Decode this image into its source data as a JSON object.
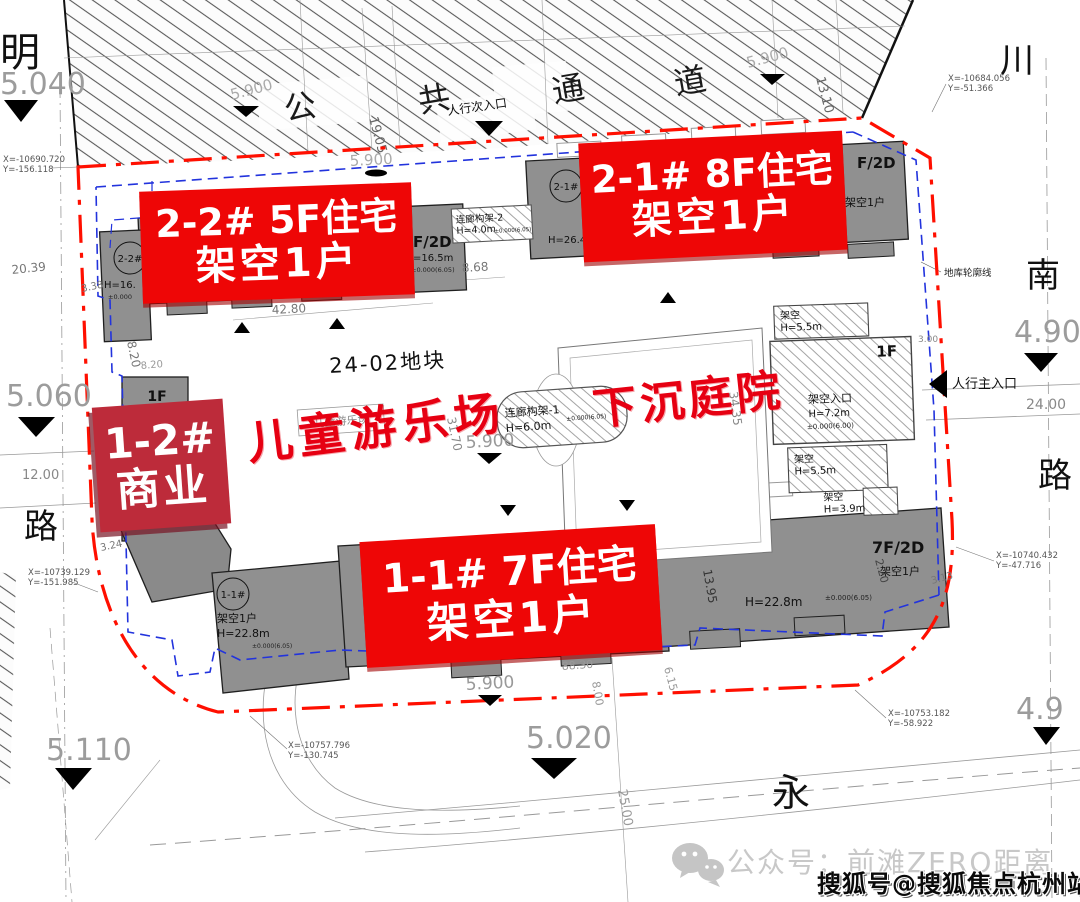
{
  "banners": {
    "b22": {
      "l1": "2-2#  5F住宅",
      "l2": "架空1户"
    },
    "b21": {
      "l1": "2-1#  8F住宅",
      "l2": "架空1户"
    },
    "b12": {
      "l1": "1-2#",
      "l2": "商业"
    },
    "b11": {
      "l1": "1-1#  7F住宅",
      "l2": "架空1户"
    }
  },
  "scripts": {
    "playground": "儿童游乐场",
    "sunken": "下沉庭院"
  },
  "roads": {
    "corridor": [
      "公",
      "共",
      "通",
      "道"
    ],
    "left_top": "明",
    "left": "路",
    "right_top": "川",
    "right_mid": "南",
    "right": "路",
    "bottom": "永"
  },
  "entrances": {
    "secondary": "人行次入口",
    "main": "人行主入口"
  },
  "plot": {
    "name": "24-02地块",
    "playground_box": "儿童游乐场",
    "garage_outline": "地库轮廓线"
  },
  "elev": {
    "e5040": "5.040",
    "e5060": "5.060",
    "e5110": "5.110",
    "e5020": "5.020",
    "e4900": "4.900",
    "e49": "4.9",
    "e59": "5.900"
  },
  "coords": {
    "c1x": "X=-10690.720",
    "c1y": "Y=-156.118",
    "c2x": "X=-10684.056",
    "c2y": "Y=-51.366",
    "c3x": "X=-10739.129",
    "c3y": "Y=-151.985",
    "c4x": "X=-10757.796",
    "c4y": "Y=-130.745",
    "c5x": "X=-10753.182",
    "c5y": "Y=-58.922",
    "c6x": "X=-10740.432",
    "c6y": "Y=-47.716"
  },
  "dims": {
    "d2039": "20.39",
    "d338": "3.38",
    "d820": "8.20",
    "d1200": "12.00",
    "d324": "3.24",
    "d4280": "42.80",
    "d868": "8.68",
    "d1905": "19.05",
    "d1310": "13.10",
    "d300": "3.00",
    "d2400": "24.00",
    "d3170": "31.70",
    "d3435": "34.35",
    "d1395": "13.95",
    "d220": "2.20",
    "d313": "3.13",
    "d8830": "88.30",
    "d800": "8.00",
    "d615": "6.15",
    "d2500": "25.00"
  },
  "bld": {
    "t22": "2-2#",
    "h165p": "H=16.",
    "pm0": "±0.000",
    "f2d": "F/2D",
    "h165": "=16.5m",
    "pm605": "±0.000(6.05)",
    "t21": "2-1#",
    "h264": "H=26.4",
    "stilt1": "架空1户",
    "f1": "1F",
    "t11": "1-1#",
    "h228": "H=22.8m",
    "f7_2d": "7F/2D"
  },
  "str": {
    "c2": "连廊构架-2",
    "c2h": "H=4.0m",
    "c1": "连廊构架-1",
    "c1h": "H=6.0m",
    "jk": "架空",
    "h55": "H=5.5m",
    "jkrk": "架空入口",
    "h72": "H=7.2m",
    "pm600": "±0.000(6.00)",
    "h39": "H=3.9m"
  },
  "watermark": {
    "wechat": "公众号：前滩ZERO距离",
    "sohu": "搜狐号@搜狐焦点杭州站"
  },
  "colors": {
    "banner_red": "#ee0606",
    "banner_crimson": "#bd2b3a",
    "script_red": "#e60012",
    "boundary_red": "#ff0f00",
    "garage_blue": "#2233dd"
  }
}
